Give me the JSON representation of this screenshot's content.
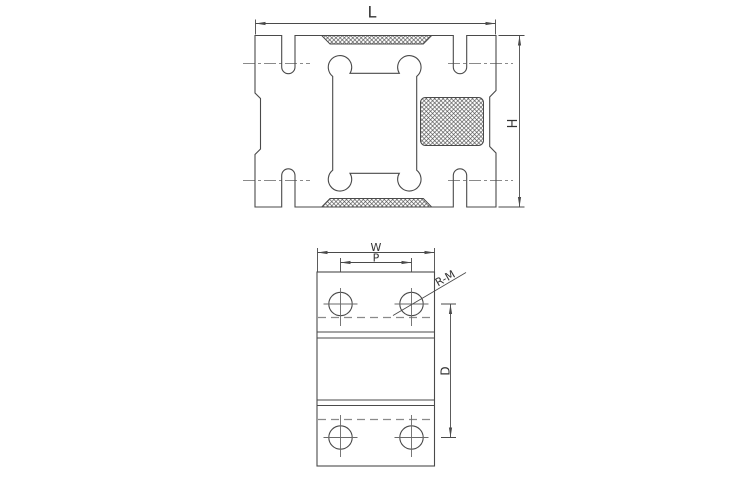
{
  "canvas": {
    "width": 750,
    "height": 489,
    "background": "#ffffff"
  },
  "colors": {
    "object_line": "#4a4a4a",
    "center_line": "#8a8a8a",
    "hidden_line": "#8a8a8a",
    "hatch_line": "#4d4d4d",
    "label_text": "#333333"
  },
  "labels": {
    "length": "L",
    "height": "H",
    "width": "W",
    "pitch": "P",
    "depth": "D",
    "thread_callout": "R-M"
  },
  "views": {
    "top": {
      "dimension_labels": [
        "L",
        "H"
      ],
      "hatch_pad_count": 3,
      "slot_count": 4
    },
    "front": {
      "dimension_labels": [
        "W",
        "P",
        "D",
        "R-M"
      ],
      "hole_count": 4
    }
  }
}
